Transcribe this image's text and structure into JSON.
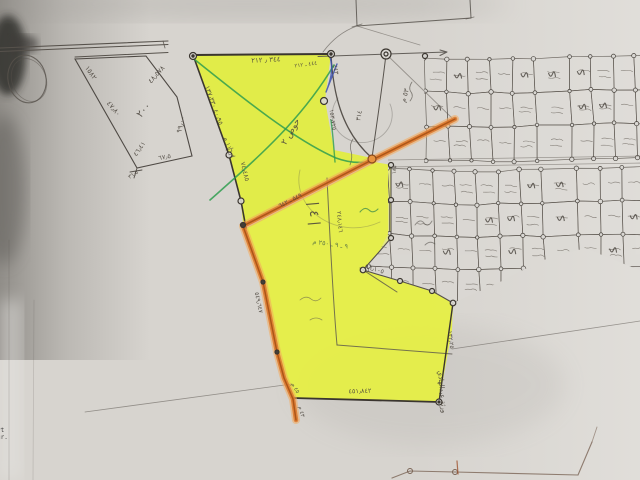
{
  "scene": "hand-drawn cadastral survey map photograph with highlighter markings",
  "colors": {
    "paper": "#d7d4cf",
    "paper_light": "#e6e4e0",
    "shadow_gray": "#57544f",
    "highlight_yellow": "#e4ef3f",
    "road_orange_light": "#f2a95c",
    "road_orange": "#dd7a30",
    "road_orange_dark": "#a34d12",
    "pen_green": "#2f9e4f",
    "pen_blue": "#3b50ae",
    "pencil": "#57524c",
    "ink_dark": "#3a352f",
    "label_ink": "#4a443c"
  },
  "corner_text": {
    "line1": "yt",
    "line2": "gr."
  },
  "labels": [
    {
      "text": "١٥٨٢",
      "x": 89,
      "y": 74,
      "rot": 55,
      "size": 7
    },
    {
      "text": "٤٧٫٨٠",
      "x": 112,
      "y": 110,
      "rot": 50,
      "size": 7
    },
    {
      "text": "٤٨٫٥٧٨",
      "x": 158,
      "y": 76,
      "rot": -48,
      "size": 7
    },
    {
      "text": "٩٩٫٠٠",
      "x": 183,
      "y": 125,
      "rot": -75,
      "size": 7
    },
    {
      "text": "٢٠٠",
      "x": 146,
      "y": 112,
      "rot": -50,
      "size": 10
    },
    {
      "text": "٤٦٫٤١",
      "x": 141,
      "y": 150,
      "rot": -55,
      "size": 6.5
    },
    {
      "text": "٦٧٫٥",
      "x": 165,
      "y": 159,
      "rot": -10,
      "size": 6.5
    },
    {
      "text": "٣٦٫٥",
      "x": 134,
      "y": 176,
      "rot": -35,
      "size": 5.5
    },
    {
      "text": "٣٤٤ ٫ ٢١٢",
      "x": 266,
      "y": 62,
      "rot": -3,
      "size": 7
    },
    {
      "text": "٤٤٤ ـ ٢١٢",
      "x": 306,
      "y": 66,
      "rot": -8,
      "size": 5.5
    },
    {
      "text": "٤٠٫٩٥ ١٣٧٫٣٣٠",
      "x": 212,
      "y": 106,
      "rot": 70,
      "size": 6.5
    },
    {
      "text": "١١٦٫١ م",
      "x": 227,
      "y": 148,
      "rot": 72,
      "size": 6.5
    },
    {
      "text": "٧٤٫٤٨٥",
      "x": 243,
      "y": 172,
      "rot": 76,
      "size": 6.5
    },
    {
      "text": "حوض ٢",
      "x": 293,
      "y": 133,
      "rot": -60,
      "size": 9
    },
    {
      "text": "٤٤٣",
      "x": 334,
      "y": 70,
      "rot": 80,
      "size": 6
    },
    {
      "text": "١٥٣٫٧٢٥",
      "x": 331,
      "y": 120,
      "rot": 82,
      "size": 6
    },
    {
      "text": "٥٣ م",
      "x": 407,
      "y": 96,
      "rot": -75,
      "size": 7
    },
    {
      "text": "٣١٤",
      "x": 361,
      "y": 116,
      "rot": -80,
      "size": 6.5
    },
    {
      "text": "٥٤٩ ـ ٦٤٢",
      "x": 291,
      "y": 202,
      "rot": -27,
      "size": 6
    },
    {
      "text": "٥٤٩٫٦٤٧",
      "x": 257,
      "y": 303,
      "rot": 78,
      "size": 6
    },
    {
      "text": "| ٤ |",
      "x": 310,
      "y": 214,
      "rot": 85,
      "size": 13
    },
    {
      "text": "٢٤٨٫١٤٦",
      "x": 338,
      "y": 222,
      "rot": 85,
      "size": 6
    },
    {
      "text": "٩ ـ ٩ ـ ٢٥٠ م",
      "x": 330,
      "y": 246,
      "rot": 8,
      "size": 6.5,
      "color": "#4f6a43"
    },
    {
      "text": "٩٦٫١٠٥",
      "x": 374,
      "y": 271,
      "rot": 16,
      "size": 6.5
    },
    {
      "text": "١٣٢٫٢٥",
      "x": 449,
      "y": 340,
      "rot": 82,
      "size": 6
    },
    {
      "text": "٤٥١٫٨٤٢",
      "x": 360,
      "y": 393,
      "rot": -2,
      "size": 6.5
    },
    {
      "text": "٤٥ م",
      "x": 294,
      "y": 389,
      "rot": 60,
      "size": 5.5
    },
    {
      "text": "٤٣ م",
      "x": 300,
      "y": 412,
      "rot": 75,
      "size": 5.5
    },
    {
      "text": "ورثة عبدالهادي",
      "x": 440,
      "y": 392,
      "rot": 85,
      "size": 7
    },
    {
      "text": "١٨٥",
      "x": 396,
      "y": 170,
      "rot": -85,
      "size": 5.5
    }
  ],
  "grid": {
    "seed": 42,
    "street_gap_x": 556,
    "street_gap_w": 13,
    "bands": [
      {
        "x0": 424,
        "y0": 55,
        "cols": 10,
        "rows": 3,
        "cw": 22,
        "rh": 34
      },
      {
        "x0": 366,
        "y0": 167,
        "cols": 13,
        "rows": 4,
        "cw": 22,
        "rh": 33
      }
    ]
  }
}
